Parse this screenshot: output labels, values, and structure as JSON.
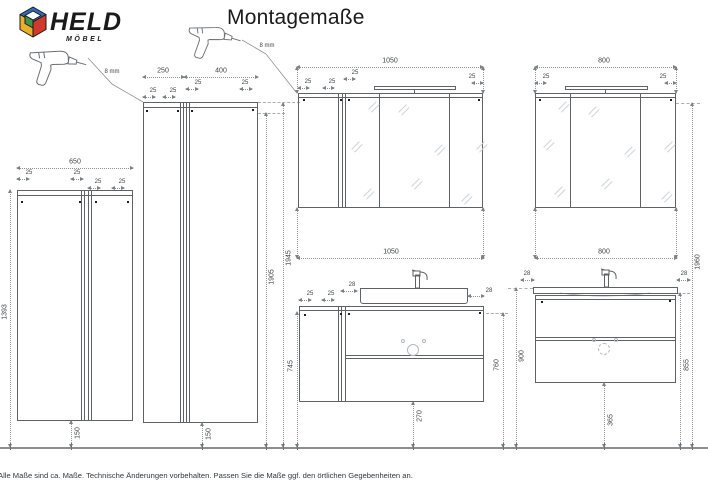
{
  "brand": {
    "name": "HELD",
    "sub": "MÖBEL"
  },
  "title": "Montagemaße",
  "drill_note_left": "8 mm",
  "drill_note_right": "8 mm",
  "footer": "Alle Maße sind ca. Maße. Technische Änderungen vorbehalten. Passen Sie die Maße ggf. den örtlichen Gegebenheiten an.",
  "logo_colors": {
    "blue": "#2e6db4",
    "red": "#d2382c",
    "yellow": "#e9b02c",
    "green": "#41934b"
  },
  "tall_cabinet_left": {
    "width": "650",
    "off": [
      "25",
      "25",
      "25",
      "25"
    ],
    "height": "1393",
    "floor_gap": "150"
  },
  "tall_cabinet_right": {
    "width_left": "250",
    "width_right": "400",
    "off": [
      "25",
      "25",
      "25",
      "25"
    ],
    "floor_gap": "150"
  },
  "wall_heights": {
    "cabinet_top": "1905",
    "light_top": "1945",
    "right_total": "1960"
  },
  "mirror_cabinet_large": {
    "width": "1050",
    "off": [
      "25",
      "25",
      "25",
      "25"
    ]
  },
  "mirror_cabinet_small": {
    "width": "800",
    "off": [
      "25",
      "25"
    ]
  },
  "vanity_large": {
    "width": "1050",
    "off": [
      "25",
      "25"
    ],
    "basin_off": [
      "28",
      "28"
    ],
    "front_height": "745",
    "top_height": "760",
    "floor_gap": "270"
  },
  "vanity_small": {
    "width": "800",
    "basin_off": [
      "28",
      "28"
    ],
    "basin_height": "900",
    "side_height": "855",
    "floor_gap": "365"
  }
}
